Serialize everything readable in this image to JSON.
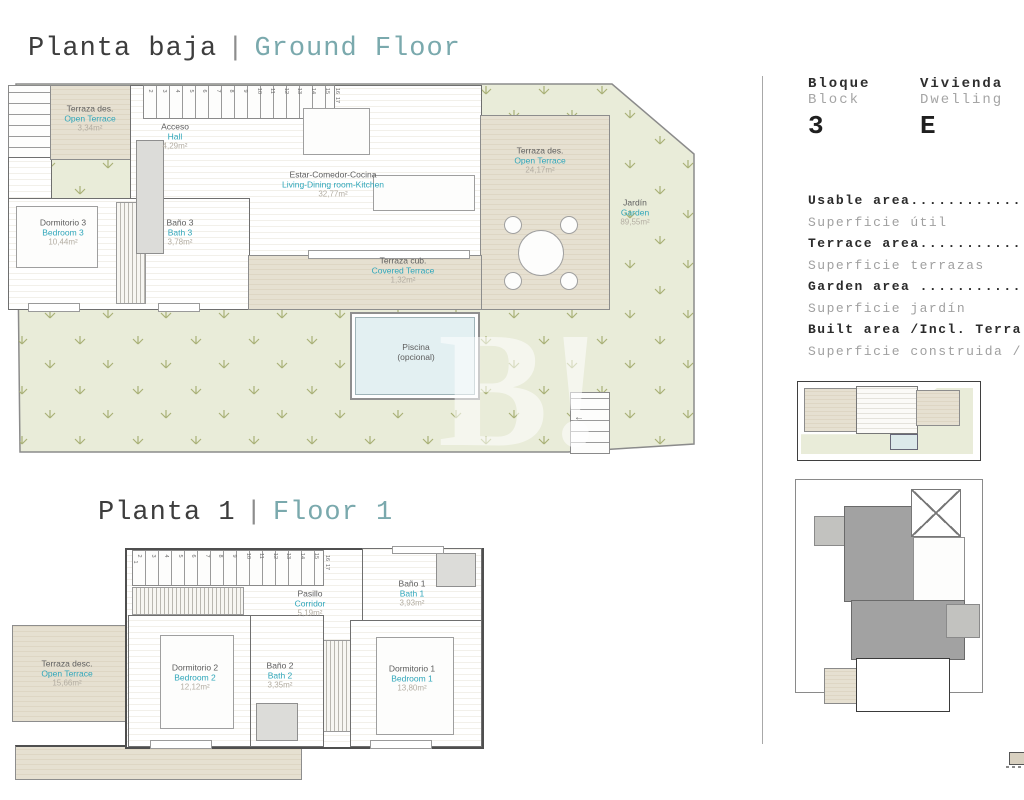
{
  "ground_floor": {
    "title_es": "Planta baja",
    "divider": "|",
    "title_en": "Ground Floor",
    "stairs_run": [
      "2",
      "3",
      "4",
      "5",
      "6",
      "7",
      "8",
      "9",
      "10",
      "11",
      "12",
      "13",
      "14",
      "15"
    ],
    "stairs_side": [
      "16",
      "17"
    ],
    "stairs_small": [
      "1",
      "2",
      "3",
      "4",
      "5"
    ],
    "rooms": {
      "open_terrace_small": {
        "es": "Terraza des.",
        "en": "Open Terrace",
        "area": "3,34m²"
      },
      "hall": {
        "es": "Acceso",
        "en": "Hall",
        "area": "4,29m²"
      },
      "living": {
        "es": "Estar-Comedor-Cocina",
        "en": "Living-Dining room-Kitchen",
        "area": "32,77m²"
      },
      "bedroom3": {
        "es": "Dormitorio 3",
        "en": "Bedroom 3",
        "area": "10,44m²"
      },
      "bath3": {
        "es": "Baño 3",
        "en": "Bath 3",
        "area": "3,78m²"
      },
      "covered_terrace": {
        "es": "Terraza cub.",
        "en": "Covered Terrace",
        "area": "1,32m²"
      },
      "open_terrace_large": {
        "es": "Terraza des.",
        "en": "Open Terrace",
        "area": "24,17m²"
      },
      "garden": {
        "es": "Jardín",
        "en": "Garden",
        "area": "89,55m²"
      },
      "pool": {
        "es": "Piscina",
        "en": "(opcional)"
      }
    }
  },
  "floor_1": {
    "title_es": "Planta 1",
    "divider": "|",
    "title_en": "Floor 1",
    "stairs_first": [
      "1"
    ],
    "stairs_run": [
      "2",
      "3",
      "4",
      "5",
      "6",
      "7",
      "8",
      "9",
      "10",
      "11",
      "12",
      "13",
      "14",
      "15"
    ],
    "stairs_side": [
      "16",
      "17"
    ],
    "rooms": {
      "corridor": {
        "es": "Pasillo",
        "en": "Corridor",
        "area": "5,19m²"
      },
      "bath1": {
        "es": "Baño 1",
        "en": "Bath 1",
        "area": "3,93m²"
      },
      "bedroom2": {
        "es": "Dormitorio 2",
        "en": "Bedroom 2",
        "area": "12,12m²"
      },
      "bath2": {
        "es": "Baño 2",
        "en": "Bath 2",
        "area": "3,35m²"
      },
      "bedroom1": {
        "es": "Dormitorio 1",
        "en": "Bedroom 1",
        "area": "13,80m²"
      },
      "open_terrace": {
        "es": "Terraza desc.",
        "en": "Open Terrace",
        "area": "15,66m²"
      }
    }
  },
  "info_panel": {
    "block": {
      "label_es": "Bloque",
      "label_en": "Block",
      "value": "3"
    },
    "dwelling": {
      "label_es": "Vivienda",
      "label_en": "Dwelling",
      "value": "E"
    },
    "areas": [
      {
        "en": "Usable area............",
        "es": "Superficie útil"
      },
      {
        "en": "Terrace area...........",
        "es": "Superficie terrazas"
      },
      {
        "en": "Garden area ...........",
        "es": "Superficie jardín"
      },
      {
        "en": "Built area /Incl. Terra",
        "es": "Superficie construida /"
      }
    ]
  },
  "watermark": {
    "text": "B!"
  },
  "colors": {
    "accent_teal": "#2fa6ba",
    "garden_green": "#e9ecd9",
    "terrace_beige": "#e2dbc9"
  }
}
